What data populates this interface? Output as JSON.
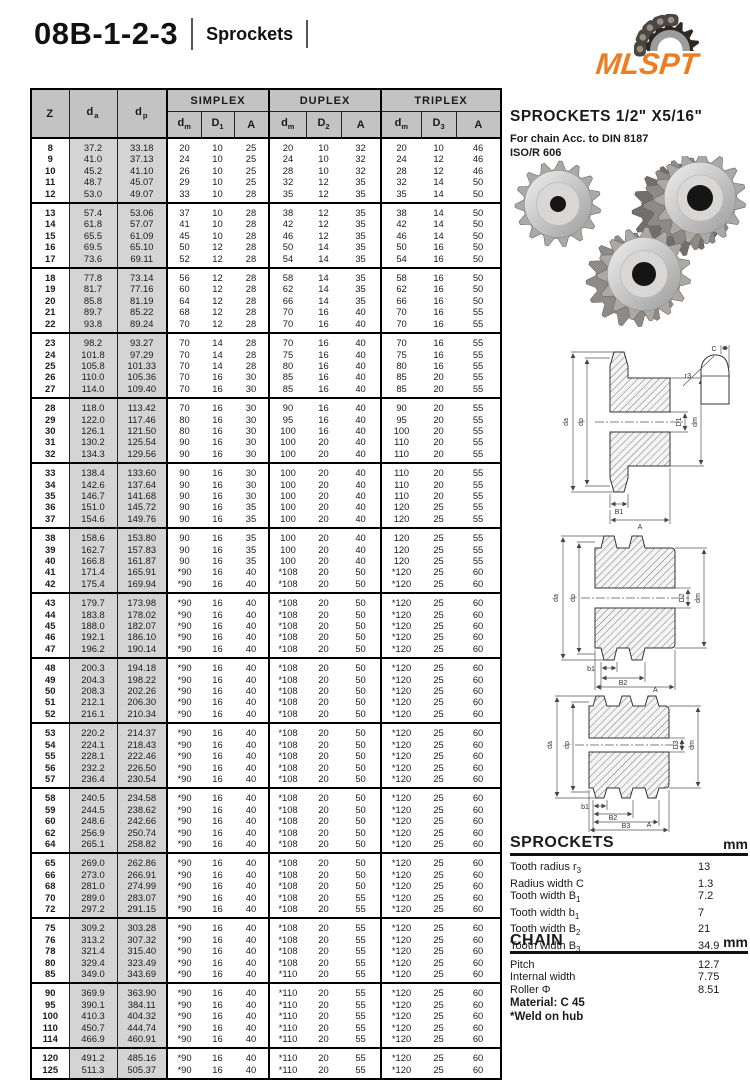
{
  "header": {
    "title": "08B-1-2-3",
    "subtitle": "Sprockets",
    "logo_text": "MLSPT"
  },
  "colors": {
    "accent_orange": "#ED7D23",
    "table_header_bg": "#c3c3c3",
    "shaded_col_bg": "#d4d4d4"
  },
  "table": {
    "head": {
      "z": "Z",
      "da": {
        "b": "d",
        "s": "a"
      },
      "dp": {
        "b": "d",
        "s": "p"
      },
      "groups": [
        {
          "name": "SIMPLEX",
          "cols": [
            {
              "b": "d",
              "s": "m"
            },
            {
              "b": "D",
              "s": "1"
            },
            {
              "b": "A",
              "s": ""
            }
          ]
        },
        {
          "name": "DUPLEX",
          "cols": [
            {
              "b": "d",
              "s": "m"
            },
            {
              "b": "D",
              "s": "2"
            },
            {
              "b": "A",
              "s": ""
            }
          ]
        },
        {
          "name": "TRIPLEX",
          "cols": [
            {
              "b": "d",
              "s": "m"
            },
            {
              "b": "D",
              "s": "3"
            },
            {
              "b": "A",
              "s": ""
            }
          ]
        }
      ]
    },
    "groups": [
      [
        [
          "8",
          "37.2",
          "33.18",
          "20",
          "10",
          "25",
          "20",
          "10",
          "32",
          "20",
          "10",
          "46"
        ],
        [
          "9",
          "41.0",
          "37.13",
          "24",
          "10",
          "25",
          "24",
          "10",
          "32",
          "24",
          "12",
          "46"
        ],
        [
          "10",
          "45.2",
          "41.10",
          "26",
          "10",
          "25",
          "28",
          "10",
          "32",
          "28",
          "12",
          "46"
        ],
        [
          "11",
          "48.7",
          "45.07",
          "29",
          "10",
          "25",
          "32",
          "12",
          "35",
          "32",
          "14",
          "50"
        ],
        [
          "12",
          "53.0",
          "49.07",
          "33",
          "10",
          "28",
          "35",
          "12",
          "35",
          "35",
          "14",
          "50"
        ]
      ],
      [
        [
          "13",
          "57.4",
          "53.06",
          "37",
          "10",
          "28",
          "38",
          "12",
          "35",
          "38",
          "14",
          "50"
        ],
        [
          "14",
          "61.8",
          "57.07",
          "41",
          "10",
          "28",
          "42",
          "12",
          "35",
          "42",
          "14",
          "50"
        ],
        [
          "15",
          "65.5",
          "61.09",
          "45",
          "10",
          "28",
          "46",
          "12",
          "35",
          "46",
          "14",
          "50"
        ],
        [
          "16",
          "69.5",
          "65.10",
          "50",
          "12",
          "28",
          "50",
          "14",
          "35",
          "50",
          "16",
          "50"
        ],
        [
          "17",
          "73.6",
          "69.11",
          "52",
          "12",
          "28",
          "54",
          "14",
          "35",
          "54",
          "16",
          "50"
        ]
      ],
      [
        [
          "18",
          "77.8",
          "73.14",
          "56",
          "12",
          "28",
          "58",
          "14",
          "35",
          "58",
          "16",
          "50"
        ],
        [
          "19",
          "81.7",
          "77.16",
          "60",
          "12",
          "28",
          "62",
          "14",
          "35",
          "62",
          "16",
          "50"
        ],
        [
          "20",
          "85.8",
          "81.19",
          "64",
          "12",
          "28",
          "66",
          "14",
          "35",
          "66",
          "16",
          "50"
        ],
        [
          "21",
          "89.7",
          "85.22",
          "68",
          "12",
          "28",
          "70",
          "16",
          "40",
          "70",
          "16",
          "55"
        ],
        [
          "22",
          "93.8",
          "89.24",
          "70",
          "12",
          "28",
          "70",
          "16",
          "40",
          "70",
          "16",
          "55"
        ]
      ],
      [
        [
          "23",
          "98.2",
          "93.27",
          "70",
          "14",
          "28",
          "70",
          "16",
          "40",
          "70",
          "16",
          "55"
        ],
        [
          "24",
          "101.8",
          "97.29",
          "70",
          "14",
          "28",
          "75",
          "16",
          "40",
          "75",
          "16",
          "55"
        ],
        [
          "25",
          "105.8",
          "101.33",
          "70",
          "14",
          "28",
          "80",
          "16",
          "40",
          "80",
          "16",
          "55"
        ],
        [
          "26",
          "110.0",
          "105.36",
          "70",
          "16",
          "30",
          "85",
          "16",
          "40",
          "85",
          "20",
          "55"
        ],
        [
          "27",
          "114.0",
          "109.40",
          "70",
          "16",
          "30",
          "85",
          "16",
          "40",
          "85",
          "20",
          "55"
        ]
      ],
      [
        [
          "28",
          "118.0",
          "113.42",
          "70",
          "16",
          "30",
          "90",
          "16",
          "40",
          "90",
          "20",
          "55"
        ],
        [
          "29",
          "122.0",
          "117.46",
          "80",
          "16",
          "30",
          "95",
          "16",
          "40",
          "95",
          "20",
          "55"
        ],
        [
          "30",
          "126.1",
          "121.50",
          "80",
          "16",
          "30",
          "100",
          "16",
          "40",
          "100",
          "20",
          "55"
        ],
        [
          "31",
          "130.2",
          "125.54",
          "90",
          "16",
          "30",
          "100",
          "20",
          "40",
          "110",
          "20",
          "55"
        ],
        [
          "32",
          "134.3",
          "129.56",
          "90",
          "16",
          "30",
          "100",
          "20",
          "40",
          "110",
          "20",
          "55"
        ]
      ],
      [
        [
          "33",
          "138.4",
          "133.60",
          "90",
          "16",
          "30",
          "100",
          "20",
          "40",
          "110",
          "20",
          "55"
        ],
        [
          "34",
          "142.6",
          "137.64",
          "90",
          "16",
          "30",
          "100",
          "20",
          "40",
          "110",
          "20",
          "55"
        ],
        [
          "35",
          "146.7",
          "141.68",
          "90",
          "16",
          "30",
          "100",
          "20",
          "40",
          "110",
          "20",
          "55"
        ],
        [
          "36",
          "151.0",
          "145.72",
          "90",
          "16",
          "35",
          "100",
          "20",
          "40",
          "120",
          "25",
          "55"
        ],
        [
          "37",
          "154.6",
          "149.76",
          "90",
          "16",
          "35",
          "100",
          "20",
          "40",
          "120",
          "25",
          "55"
        ]
      ],
      [
        [
          "38",
          "158.6",
          "153.80",
          "90",
          "16",
          "35",
          "100",
          "20",
          "40",
          "120",
          "25",
          "55"
        ],
        [
          "39",
          "162.7",
          "157.83",
          "90",
          "16",
          "35",
          "100",
          "20",
          "40",
          "120",
          "25",
          "55"
        ],
        [
          "40",
          "166.8",
          "161.87",
          "90",
          "16",
          "35",
          "100",
          "20",
          "40",
          "120",
          "25",
          "55"
        ],
        [
          "41",
          "171.4",
          "165.91",
          "*90",
          "16",
          "40",
          "*108",
          "20",
          "50",
          "*120",
          "25",
          "60"
        ],
        [
          "42",
          "175.4",
          "169.94",
          "*90",
          "16",
          "40",
          "*108",
          "20",
          "50",
          "*120",
          "25",
          "60"
        ]
      ],
      [
        [
          "43",
          "179.7",
          "173.98",
          "*90",
          "16",
          "40",
          "*108",
          "20",
          "50",
          "*120",
          "25",
          "60"
        ],
        [
          "44",
          "183.8",
          "178.02",
          "*90",
          "16",
          "40",
          "*108",
          "20",
          "50",
          "*120",
          "25",
          "60"
        ],
        [
          "45",
          "188.0",
          "182.07",
          "*90",
          "16",
          "40",
          "*108",
          "20",
          "50",
          "*120",
          "25",
          "60"
        ],
        [
          "46",
          "192.1",
          "186.10",
          "*90",
          "16",
          "40",
          "*108",
          "20",
          "50",
          "*120",
          "25",
          "60"
        ],
        [
          "47",
          "196.2",
          "190.14",
          "*90",
          "16",
          "40",
          "*108",
          "20",
          "50",
          "*120",
          "25",
          "60"
        ]
      ],
      [
        [
          "48",
          "200.3",
          "194.18",
          "*90",
          "16",
          "40",
          "*108",
          "20",
          "50",
          "*120",
          "25",
          "60"
        ],
        [
          "49",
          "204.3",
          "198.22",
          "*90",
          "16",
          "40",
          "*108",
          "20",
          "50",
          "*120",
          "25",
          "60"
        ],
        [
          "50",
          "208.3",
          "202.26",
          "*90",
          "16",
          "40",
          "*108",
          "20",
          "50",
          "*120",
          "25",
          "60"
        ],
        [
          "51",
          "212.1",
          "206.30",
          "*90",
          "16",
          "40",
          "*108",
          "20",
          "50",
          "*120",
          "25",
          "60"
        ],
        [
          "52",
          "216.1",
          "210.34",
          "*90",
          "16",
          "40",
          "*108",
          "20",
          "50",
          "*120",
          "25",
          "60"
        ]
      ],
      [
        [
          "53",
          "220.2",
          "214.37",
          "*90",
          "16",
          "40",
          "*108",
          "20",
          "50",
          "*120",
          "25",
          "60"
        ],
        [
          "54",
          "224.1",
          "218.43",
          "*90",
          "16",
          "40",
          "*108",
          "20",
          "50",
          "*120",
          "25",
          "60"
        ],
        [
          "55",
          "228.1",
          "222.46",
          "*90",
          "16",
          "40",
          "*108",
          "20",
          "50",
          "*120",
          "25",
          "60"
        ],
        [
          "56",
          "232.2",
          "226.50",
          "*90",
          "16",
          "40",
          "*108",
          "20",
          "50",
          "*120",
          "25",
          "60"
        ],
        [
          "57",
          "236.4",
          "230.54",
          "*90",
          "16",
          "40",
          "*108",
          "20",
          "50",
          "*120",
          "25",
          "60"
        ]
      ],
      [
        [
          "58",
          "240.5",
          "234.58",
          "*90",
          "16",
          "40",
          "*108",
          "20",
          "50",
          "*120",
          "25",
          "60"
        ],
        [
          "59",
          "244.5",
          "238.62",
          "*90",
          "16",
          "40",
          "*108",
          "20",
          "50",
          "*120",
          "25",
          "60"
        ],
        [
          "60",
          "248.6",
          "242.66",
          "*90",
          "16",
          "40",
          "*108",
          "20",
          "50",
          "*120",
          "25",
          "60"
        ],
        [
          "62",
          "256.9",
          "250.74",
          "*90",
          "16",
          "40",
          "*108",
          "20",
          "50",
          "*120",
          "25",
          "60"
        ],
        [
          "64",
          "265.1",
          "258.82",
          "*90",
          "16",
          "40",
          "*108",
          "20",
          "50",
          "*120",
          "25",
          "60"
        ]
      ],
      [
        [
          "65",
          "269.0",
          "262.86",
          "*90",
          "16",
          "40",
          "*108",
          "20",
          "50",
          "*120",
          "25",
          "60"
        ],
        [
          "66",
          "273.0",
          "266.91",
          "*90",
          "16",
          "40",
          "*108",
          "20",
          "50",
          "*120",
          "25",
          "60"
        ],
        [
          "68",
          "281.0",
          "274.99",
          "*90",
          "16",
          "40",
          "*108",
          "20",
          "50",
          "*120",
          "25",
          "60"
        ],
        [
          "70",
          "289.0",
          "283.07",
          "*90",
          "16",
          "40",
          "*108",
          "20",
          "55",
          "*120",
          "25",
          "60"
        ],
        [
          "72",
          "297.2",
          "291.15",
          "*90",
          "16",
          "40",
          "*108",
          "20",
          "55",
          "*120",
          "25",
          "60"
        ]
      ],
      [
        [
          "75",
          "309.2",
          "303.28",
          "*90",
          "16",
          "40",
          "*108",
          "20",
          "55",
          "*120",
          "25",
          "60"
        ],
        [
          "76",
          "313.2",
          "307.32",
          "*90",
          "16",
          "40",
          "*108",
          "20",
          "55",
          "*120",
          "25",
          "60"
        ],
        [
          "78",
          "321.4",
          "315.40",
          "*90",
          "16",
          "40",
          "*108",
          "20",
          "55",
          "*120",
          "25",
          "60"
        ],
        [
          "80",
          "329.4",
          "323.49",
          "*90",
          "16",
          "40",
          "*108",
          "20",
          "55",
          "*120",
          "25",
          "60"
        ],
        [
          "85",
          "349.0",
          "343.69",
          "*90",
          "16",
          "40",
          "*110",
          "20",
          "55",
          "*120",
          "25",
          "60"
        ]
      ],
      [
        [
          "90",
          "369.9",
          "363.90",
          "*90",
          "16",
          "40",
          "*110",
          "20",
          "55",
          "*120",
          "25",
          "60"
        ],
        [
          "95",
          "390.1",
          "384.11",
          "*90",
          "16",
          "40",
          "*110",
          "20",
          "55",
          "*120",
          "25",
          "60"
        ],
        [
          "100",
          "410.3",
          "404.32",
          "*90",
          "16",
          "40",
          "*110",
          "20",
          "55",
          "*120",
          "25",
          "60"
        ],
        [
          "110",
          "450.7",
          "444.74",
          "*90",
          "16",
          "40",
          "*110",
          "20",
          "55",
          "*120",
          "25",
          "60"
        ],
        [
          "114",
          "466.9",
          "460.91",
          "*90",
          "16",
          "40",
          "*110",
          "20",
          "55",
          "*120",
          "25",
          "60"
        ]
      ],
      [
        [
          "120",
          "491.2",
          "485.16",
          "*90",
          "16",
          "40",
          "*110",
          "20",
          "55",
          "*120",
          "25",
          "60"
        ],
        [
          "125",
          "511.3",
          "505.37",
          "*90",
          "16",
          "40",
          "*110",
          "20",
          "55",
          "*120",
          "25",
          "60"
        ]
      ]
    ]
  },
  "panel": {
    "heading": "SPROCKETS 1/2\" X5/16\"",
    "sub1": "For chain Acc. to DIN 8187",
    "sub2": "ISO/R 606",
    "sprockets_spec": {
      "title": "SPROCKETS",
      "unit": "mm",
      "rows": [
        [
          "Tooth radius r",
          "3",
          "13"
        ],
        [
          "Radius width C",
          "",
          "1.3"
        ],
        [
          "Tooth width B",
          "1",
          "7.2"
        ],
        [
          "Tooth width b",
          "1",
          "7"
        ],
        [
          "Tooth width B",
          "2",
          "21"
        ],
        [
          "Tooth width B",
          "3",
          "34.9"
        ]
      ]
    },
    "chain_spec": {
      "title": "CHAIN",
      "unit": "mm",
      "rows": [
        [
          "Pitch",
          "",
          "12.7"
        ],
        [
          "Internal width",
          "",
          "7.75"
        ],
        [
          "Roller Φ",
          "",
          "8.51"
        ]
      ]
    },
    "material": "Material: C 45",
    "weld_note": "*Weld on hub"
  },
  "diagrams": {
    "simplex": {
      "labels": [
        "da",
        "dp",
        "D1",
        "dm",
        "B1",
        "A",
        "C",
        "r3"
      ]
    },
    "duplex": {
      "labels": [
        "da",
        "dp",
        "D2",
        "dm",
        "b1",
        "B2",
        "A"
      ]
    },
    "triplex": {
      "labels": [
        "da",
        "dp",
        "D3",
        "dm",
        "b1",
        "B2",
        "B3",
        "A"
      ]
    }
  }
}
